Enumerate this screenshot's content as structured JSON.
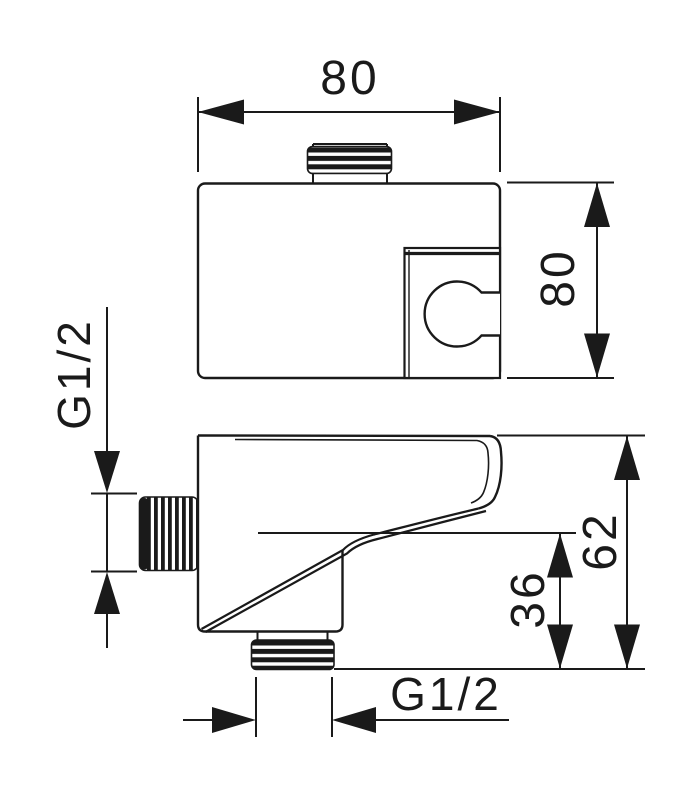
{
  "drawing": {
    "kind": "technical dimension drawing (two views: top view and side view)",
    "colors": {
      "line": "#1a1a1a",
      "background": "#ffffff"
    },
    "labels": {
      "top_width": "80",
      "front_height": "80",
      "inlet_thread": "G1/2",
      "depth_total": "62",
      "depth_outlet": "36",
      "outlet_thread": "G1/2"
    }
  }
}
